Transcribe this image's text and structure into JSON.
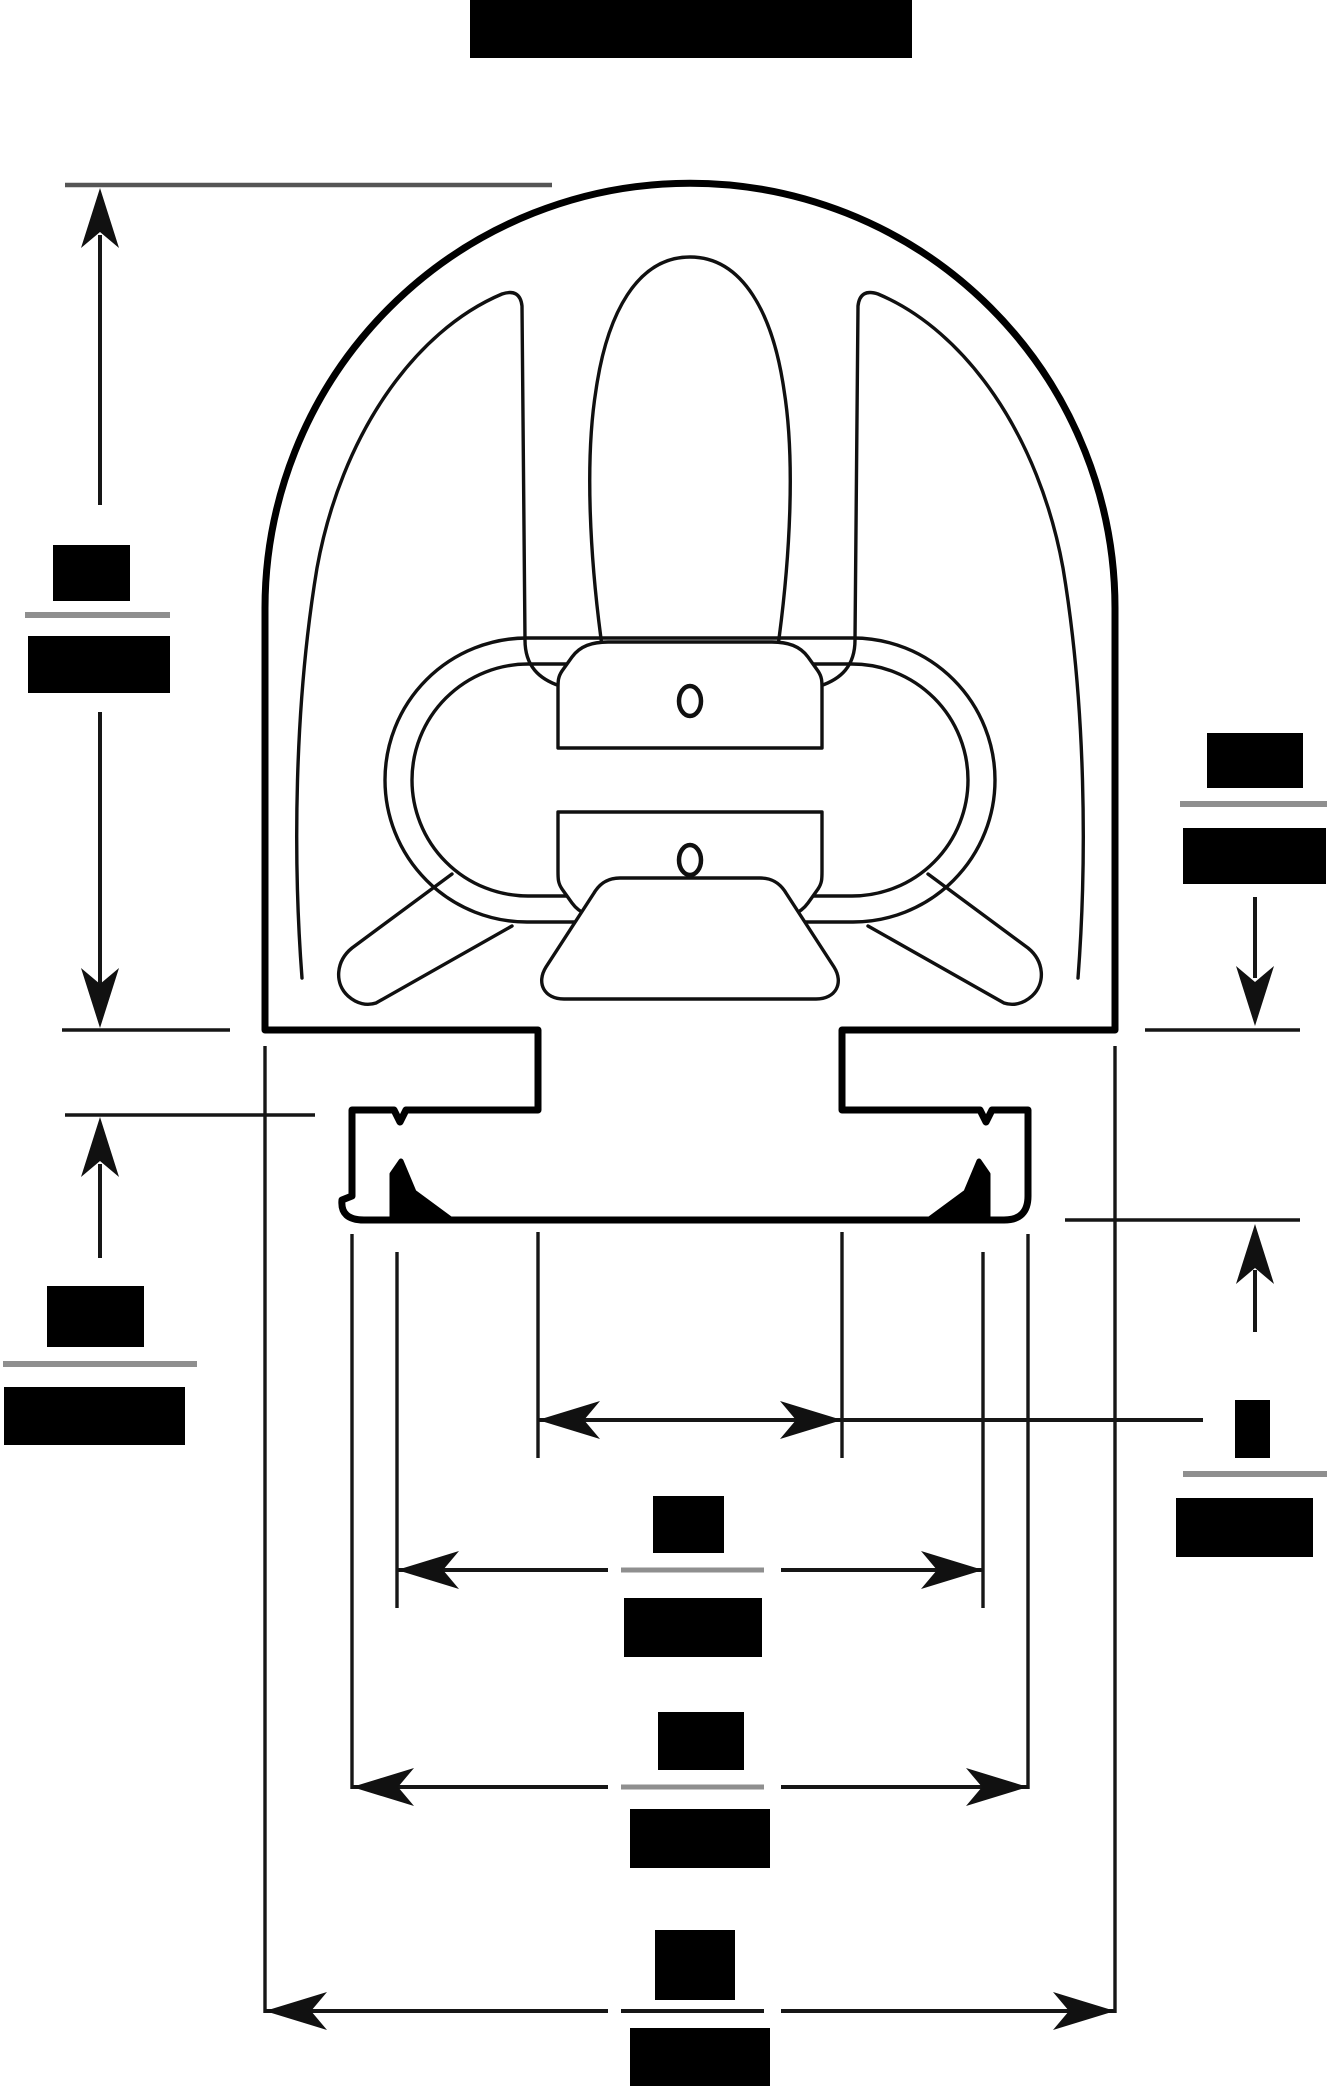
{
  "document": {
    "type": "technical-drawing-cross-section",
    "description_visible_text": "",
    "title_redacted": true
  },
  "colors": {
    "background": "#ffffff",
    "outline": "#000000",
    "inner_line": "#101010",
    "dim_line": "#161616",
    "ext_line_gray": "#555555",
    "fraction_bar": "#8f8f8f",
    "redaction": "#000000"
  },
  "profile": {
    "screw_holes_count": 2,
    "features": [
      "dome-shell",
      "inner-liner",
      "bulb-cavity",
      "oval-ring",
      "upper-clamp-plate",
      "lower-clamp-plate",
      "upper-screw-hole",
      "lower-screw-hole",
      "left-leg-strut",
      "right-leg-strut",
      "trapezoid-boss",
      "left-shoulder",
      "right-shoulder",
      "stem",
      "mounting-flange",
      "left-barb",
      "right-barb",
      "t-slot-base"
    ]
  },
  "dimensions": [
    {
      "id": "dome-height",
      "orientation": "vertical",
      "side": "left",
      "label_top_redacted": true,
      "label_bottom_redacted": true,
      "has_fraction_bar": true
    },
    {
      "id": "stem-height",
      "orientation": "vertical",
      "side": "left",
      "label_top_redacted": true,
      "label_bottom_redacted": true,
      "has_fraction_bar": true
    },
    {
      "id": "base-height",
      "orientation": "vertical",
      "side": "right",
      "label_top_redacted": true,
      "label_bottom_redacted": true,
      "has_fraction_bar": true
    },
    {
      "id": "stem-width",
      "orientation": "horizontal",
      "row": 1,
      "label_top_redacted": true,
      "label_bottom_redacted": true,
      "has_fraction_bar": true,
      "has_leader": true
    },
    {
      "id": "slot-outer-width",
      "orientation": "horizontal",
      "row": 2,
      "label_top_redacted": true,
      "label_bottom_redacted": true,
      "has_fraction_bar": true
    },
    {
      "id": "flange-width",
      "orientation": "horizontal",
      "row": 3,
      "label_top_redacted": true,
      "label_bottom_redacted": true,
      "has_fraction_bar": true
    },
    {
      "id": "overall-width",
      "orientation": "horizontal",
      "row": 4,
      "label_top_redacted": true,
      "label_bottom_redacted": true,
      "has_fraction_bar": false
    }
  ]
}
